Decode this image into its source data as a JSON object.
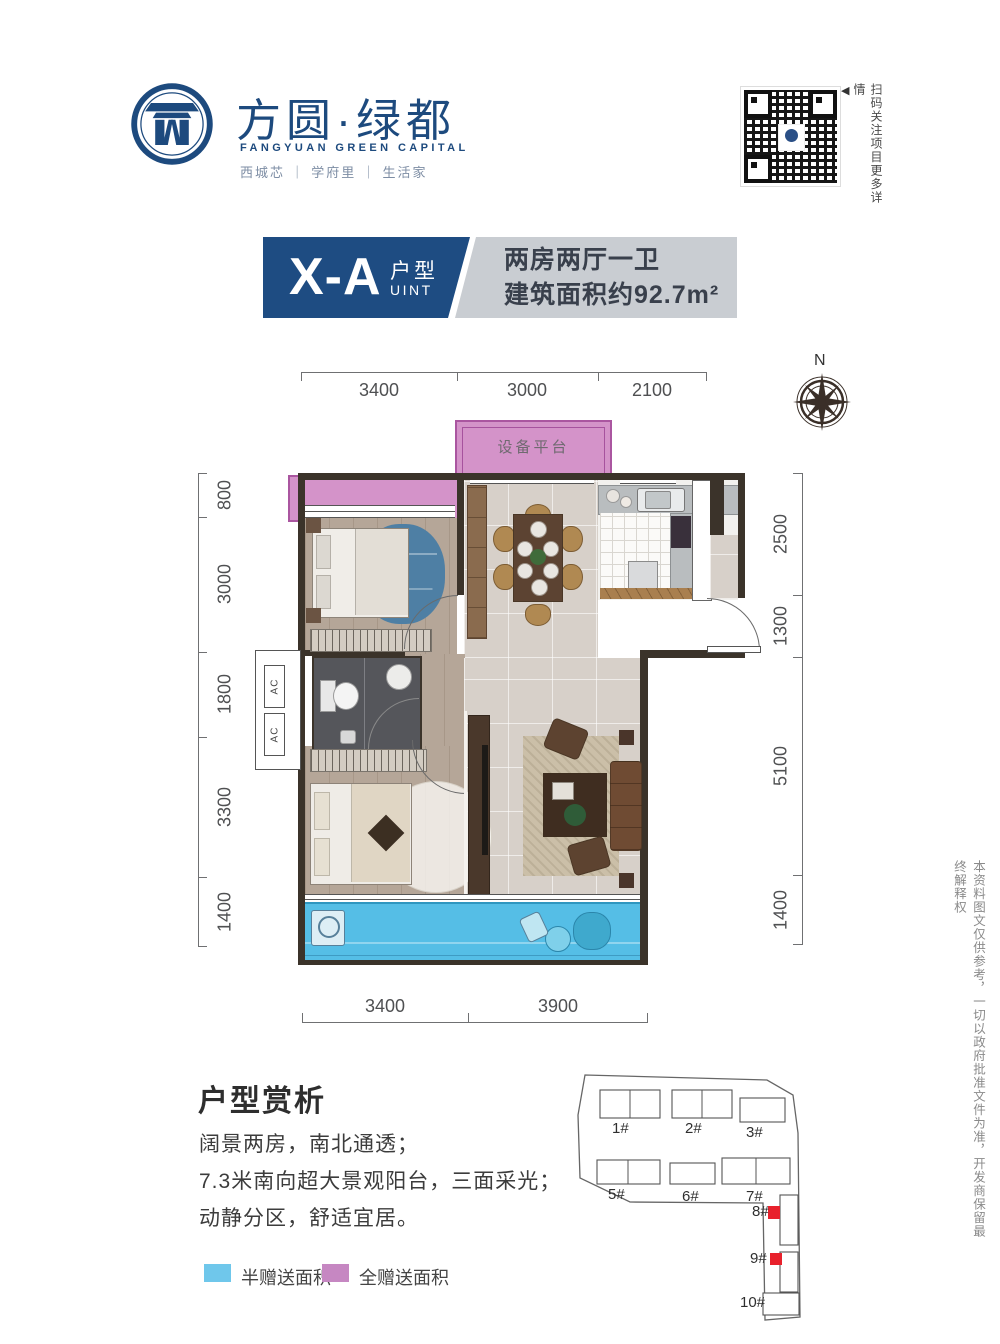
{
  "brand": {
    "name_cn": "方圆·绿都",
    "name_en": "FANGYUAN GREEN CAPITAL",
    "slogan": "西城芯 ｜ 学府里 ｜ 生活家",
    "qr_caption": "扫码关注项目更多详情",
    "qr_arrow": "◀"
  },
  "unit": {
    "code": "X-A",
    "type_cn": "户型",
    "type_en": "UINT",
    "layout": "两房两厅一卫",
    "area": "建筑面积约92.7m²"
  },
  "plan": {
    "compass": "N",
    "equipment_platform": "设备平台",
    "ac_label": "AC",
    "dims": {
      "top": [
        "3400",
        "3000",
        "2100"
      ],
      "left": [
        "800",
        "3000",
        "1800",
        "3300",
        "1400"
      ],
      "right": [
        "2500",
        "1300",
        "5100",
        "1400"
      ],
      "bottom": [
        "3400",
        "3900"
      ]
    }
  },
  "analysis": {
    "heading": "户型赏析",
    "lines": [
      "阔景两房，南北通透；",
      "7.3米南向超大景观阳台，三面采光；",
      "动静分区，舒适宜居。"
    ]
  },
  "legend": {
    "half_gift": "半赠送面积",
    "full_gift": "全赠送面积"
  },
  "siteplan": {
    "buildings": [
      "1#",
      "2#",
      "3#",
      "5#",
      "6#",
      "7#",
      "8#",
      "9#",
      "10#"
    ]
  },
  "disclaimer": "本资料图文仅供参考，一切以政府批准文件为准，开发商保留最终解释权",
  "colors": {
    "navy": "#1e4c82",
    "title_gray": "#c9cdd2",
    "pink": "#d493c9",
    "balcony_blue": "#55bee6",
    "legend_blue": "#6fc7eb",
    "legend_pink": "#c687c2",
    "highlight_red": "#e8212c"
  }
}
